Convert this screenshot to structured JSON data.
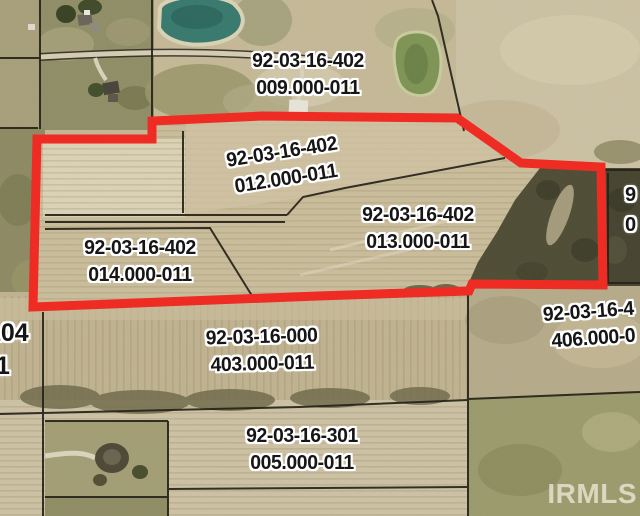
{
  "map": {
    "watermark": "IRMLS",
    "boundary_color": "#ee2c23",
    "label_color": "#161616",
    "parcel_labels": {
      "p009": {
        "line1": "92-03-16-402",
        "line2": "009.000-011"
      },
      "p012": {
        "line1": "92-03-16-402",
        "line2": "012.000-011"
      },
      "p013": {
        "line1": "92-03-16-402",
        "line2": "013.000-011"
      },
      "p014": {
        "line1": "92-03-16-402",
        "line2": "014.000-011"
      },
      "p403": {
        "line1": "92-03-16-000",
        "line2": "403.000-011"
      },
      "p005": {
        "line1": "92-03-16-301",
        "line2": "005.000-011"
      },
      "p406": {
        "line1": "92-03-16-4",
        "line2": "406.000-0"
      },
      "edge_left": {
        "line1": "104",
        "line2": "1"
      },
      "edge_right": {
        "line1": "9",
        "line2": "0"
      }
    }
  }
}
